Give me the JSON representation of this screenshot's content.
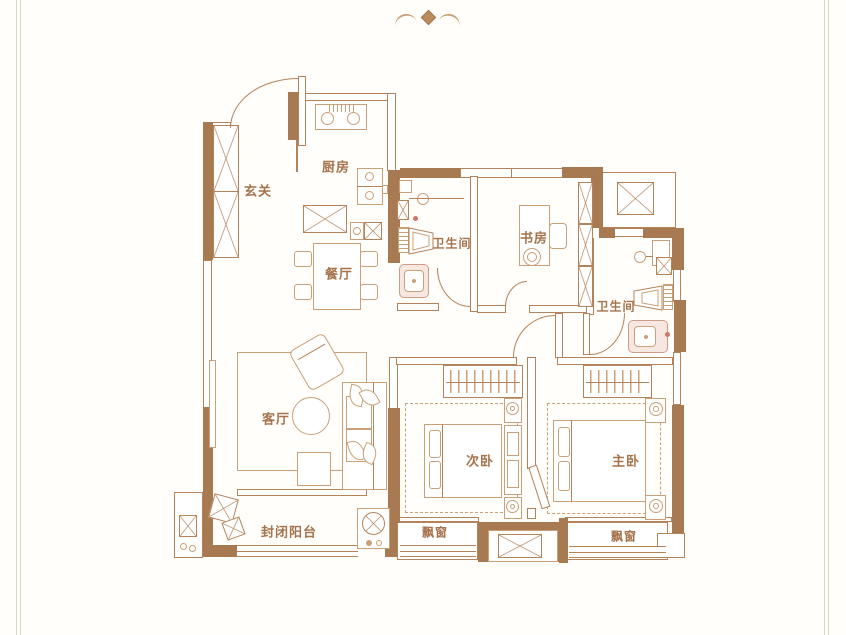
{
  "figure_type": "apartment-floor-plan",
  "palette": {
    "wall": "#a87a52",
    "line": "#b5835a",
    "furn": "#c9a077",
    "lbl": "#a5734c",
    "pinkbg": "#f6e8e1",
    "pinkbd": "#d09a89",
    "frame": "#dcd5c6",
    "bg": "#fffefb"
  },
  "emblem": {
    "icon": "wings-emblem-icon"
  },
  "rooms": [
    {
      "id": "foyer",
      "label": "玄关"
    },
    {
      "id": "kitchen",
      "label": "厨房"
    },
    {
      "id": "dining",
      "label": "餐厅"
    },
    {
      "id": "bath1",
      "label": "卫生间"
    },
    {
      "id": "study",
      "label": "书房"
    },
    {
      "id": "bath2",
      "label": "卫生间"
    },
    {
      "id": "living",
      "label": "客厅"
    },
    {
      "id": "balcony",
      "label": "封闭阳台"
    },
    {
      "id": "bedroom2",
      "label": "次卧"
    },
    {
      "id": "master",
      "label": "主卧"
    },
    {
      "id": "bay-left",
      "label": "飘窗"
    },
    {
      "id": "bay-right",
      "label": "飘窗"
    }
  ]
}
